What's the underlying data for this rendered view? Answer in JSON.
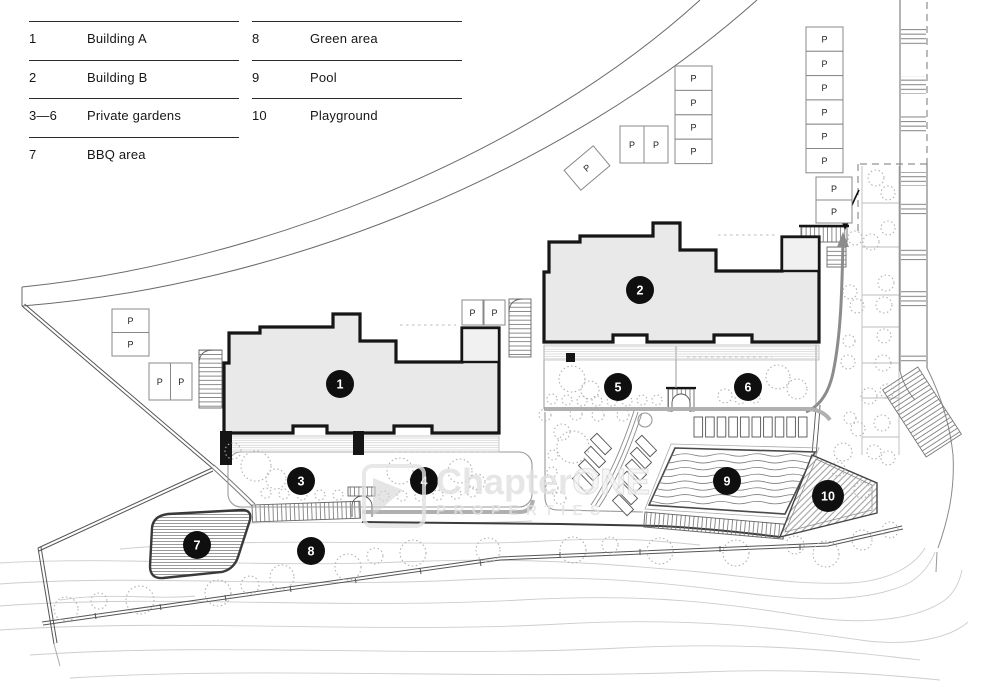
{
  "plan": {
    "legend": {
      "col1": [
        {
          "num": "1",
          "label": "Building A"
        },
        {
          "num": "2",
          "label": "Building B"
        },
        {
          "num": "3—6",
          "label": "Private gardens"
        },
        {
          "num": "7",
          "label": "BBQ area"
        }
      ],
      "col2": [
        {
          "num": "8",
          "label": "Green area"
        },
        {
          "num": "9",
          "label": "Pool"
        },
        {
          "num": "10",
          "label": "Playground"
        }
      ]
    },
    "markers": [
      "1",
      "2",
      "3",
      "4",
      "5",
      "6",
      "7",
      "8",
      "9",
      "10"
    ],
    "parking_label": "P",
    "watermark": {
      "brand_a": "Chapter",
      "brand_b": "ONE",
      "subtitle": "PROPERTIES"
    },
    "colors": {
      "building_fill": "#e9e9e9",
      "building_outline": "#161616",
      "marker_fill": "#0f0f0f",
      "watermark_gray": "#e0e0e0"
    }
  }
}
